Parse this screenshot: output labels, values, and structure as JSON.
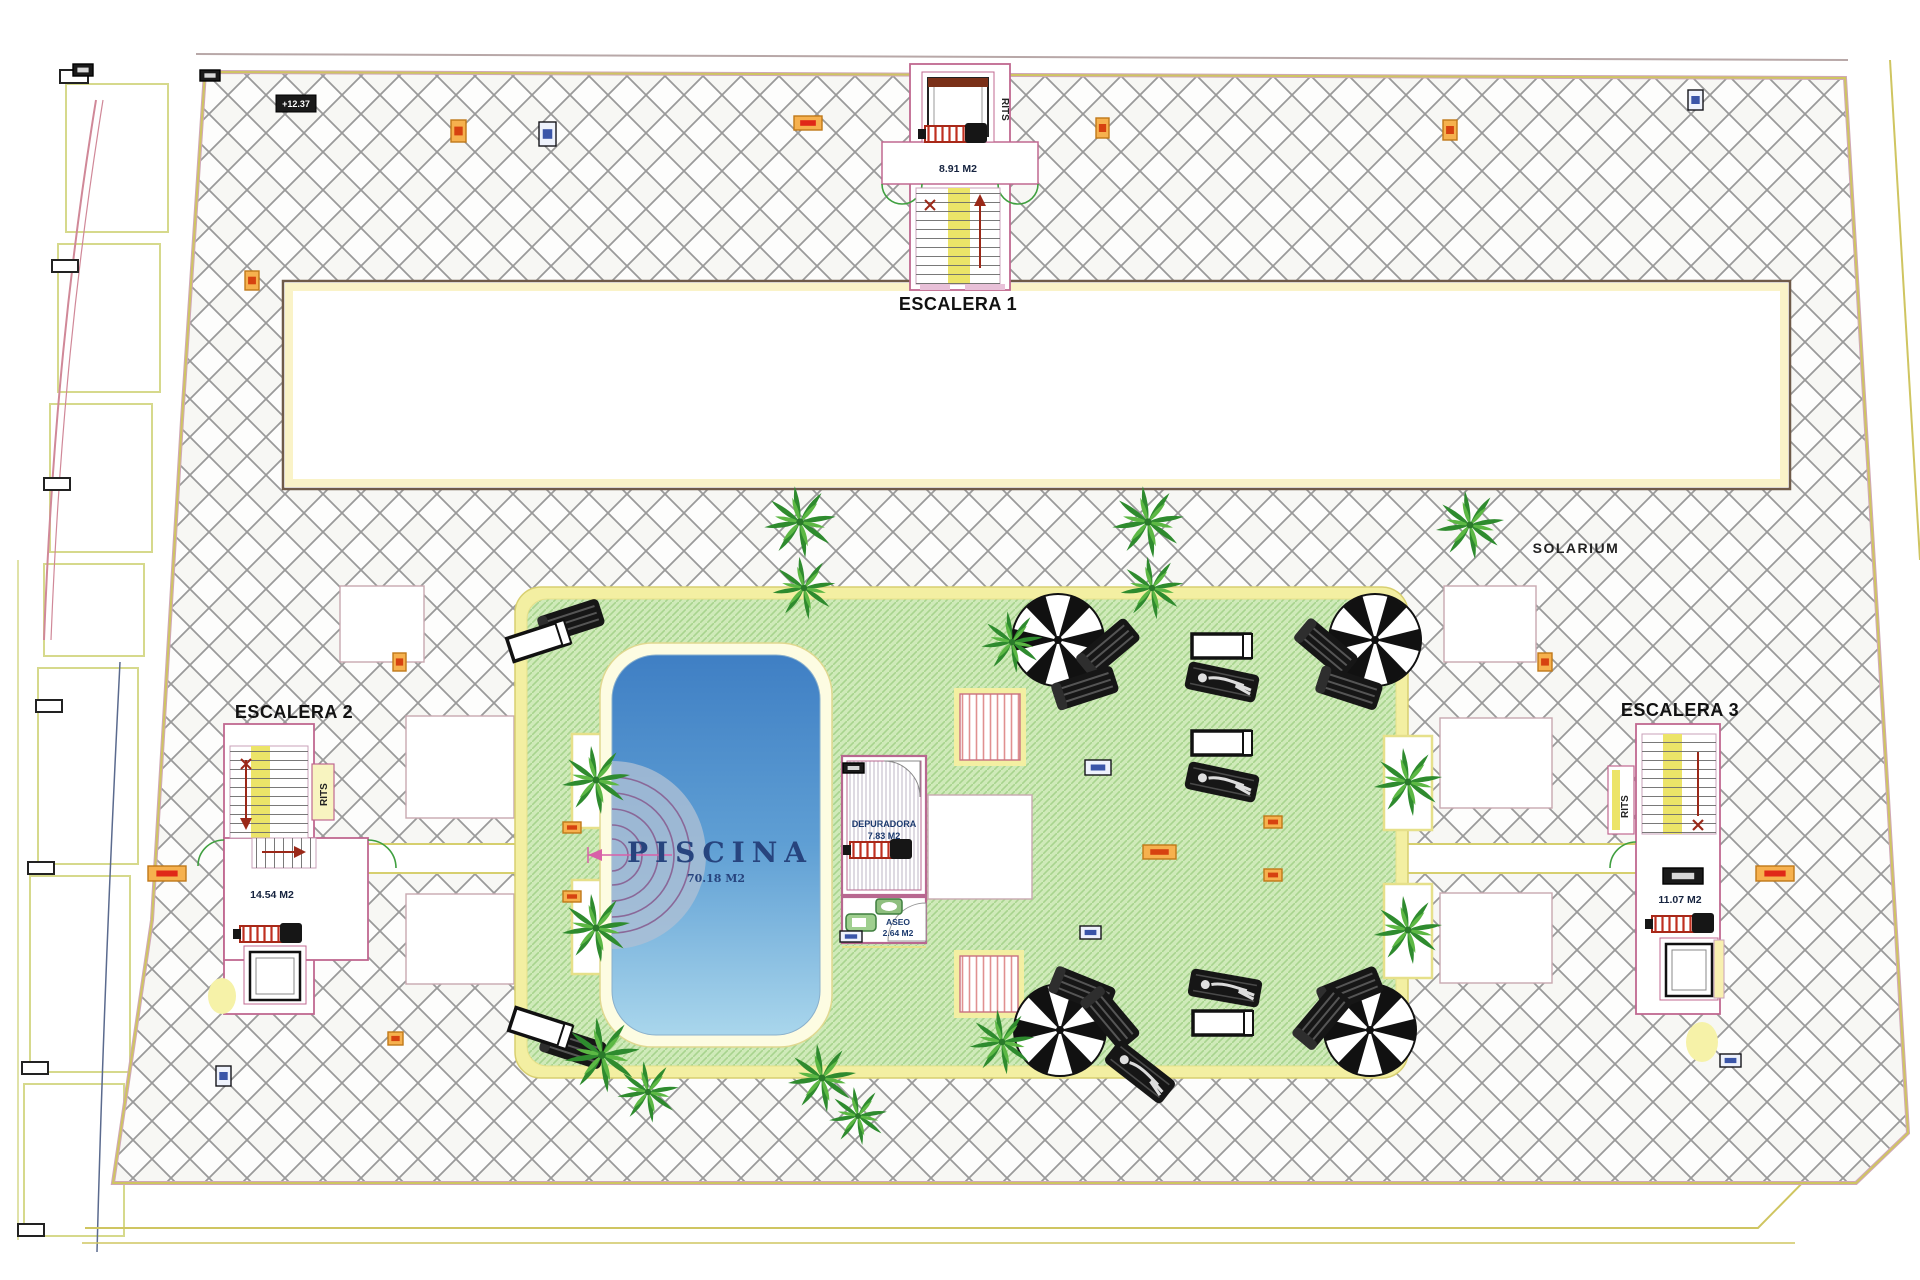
{
  "plan": {
    "solarium_label": "SOLARIUM",
    "level_marker": "+12.37",
    "escalera1": {
      "title": "ESCALERA 1",
      "area": "8.91 M2",
      "rits": "RITS"
    },
    "escalera2": {
      "title": "ESCALERA 2",
      "area": "14.54 M2",
      "rits": "RITS"
    },
    "escalera3": {
      "title": "ESCALERA 3",
      "area": "11.07 M2",
      "rits": "RITS"
    },
    "piscina": {
      "title": "PISCINA",
      "area": "70.18 M2"
    },
    "depuradora": {
      "title": "DEPURADORA",
      "area": "7.83 M2"
    },
    "aseo": {
      "title": "ASEO",
      "area": "2.64 M2"
    }
  },
  "colors": {
    "hatch_line": "#9a9a9a",
    "site_border_yellow": "#cfc561",
    "site_border_pink": "#d0a8b8",
    "deck_border": "#f3efa2",
    "deck_green": "#cfeab9",
    "deck_stripe": "#a8d48e",
    "pool_top": "#3f7fc4",
    "pool_bottom": "#a9d6ec",
    "room_outline": "#b86890",
    "stair_yellow": "#ece468",
    "door_arc_green": "#3f9f3f",
    "text_navy": "#1c3a6e",
    "red_arrow": "#9a2818"
  },
  "marker_styles": {
    "orange": {
      "fill": "#f6b14e",
      "stroke": "#c07818",
      "inner": "#d64210"
    },
    "blue": {
      "fill": "#eef2fc",
      "stroke": "#15151a",
      "inner": "#3a55a8"
    },
    "black": {
      "fill": "#1a1a1a",
      "stroke": "#000000",
      "inner": "#d8d8d8"
    },
    "red": {
      "fill": "#f6b14e",
      "stroke": "#c07818",
      "inner": "#e02818"
    }
  },
  "markers": [
    {
      "x": 73,
      "y": 64,
      "w": 20,
      "h": 12,
      "type": "black"
    },
    {
      "x": 200,
      "y": 70,
      "w": 20,
      "h": 11,
      "type": "black"
    },
    {
      "x": 451,
      "y": 120,
      "w": 15,
      "h": 22,
      "type": "orange"
    },
    {
      "x": 539,
      "y": 122,
      "w": 17,
      "h": 24,
      "type": "blue"
    },
    {
      "x": 794,
      "y": 116,
      "w": 28,
      "h": 14,
      "type": "red"
    },
    {
      "x": 1096,
      "y": 118,
      "w": 13,
      "h": 20,
      "type": "orange"
    },
    {
      "x": 1443,
      "y": 120,
      "w": 14,
      "h": 20,
      "type": "orange"
    },
    {
      "x": 1688,
      "y": 90,
      "w": 15,
      "h": 20,
      "type": "blue"
    },
    {
      "x": 245,
      "y": 271,
      "w": 14,
      "h": 19,
      "type": "orange"
    },
    {
      "x": 393,
      "y": 653,
      "w": 13,
      "h": 18,
      "type": "orange"
    },
    {
      "x": 148,
      "y": 866,
      "w": 38,
      "h": 15,
      "type": "red"
    },
    {
      "x": 388,
      "y": 1032,
      "w": 15,
      "h": 13,
      "type": "orange"
    },
    {
      "x": 216,
      "y": 1066,
      "w": 15,
      "h": 20,
      "type": "blue"
    },
    {
      "x": 563,
      "y": 822,
      "w": 18,
      "h": 11,
      "type": "orange"
    },
    {
      "x": 563,
      "y": 891,
      "w": 18,
      "h": 11,
      "type": "orange"
    },
    {
      "x": 1085,
      "y": 760,
      "w": 26,
      "h": 15,
      "type": "blue"
    },
    {
      "x": 1080,
      "y": 926,
      "w": 21,
      "h": 13,
      "type": "blue"
    },
    {
      "x": 1143,
      "y": 845,
      "w": 33,
      "h": 14,
      "type": "orange"
    },
    {
      "x": 1264,
      "y": 816,
      "w": 18,
      "h": 12,
      "type": "orange"
    },
    {
      "x": 1264,
      "y": 869,
      "w": 18,
      "h": 12,
      "type": "orange"
    },
    {
      "x": 1538,
      "y": 653,
      "w": 14,
      "h": 18,
      "type": "orange"
    },
    {
      "x": 1756,
      "y": 866,
      "w": 38,
      "h": 15,
      "type": "red"
    },
    {
      "x": 1720,
      "y": 1054,
      "w": 21,
      "h": 13,
      "type": "blue"
    },
    {
      "x": 840,
      "y": 931,
      "w": 22,
      "h": 11,
      "type": "blue"
    },
    {
      "x": 843,
      "y": 763,
      "w": 21,
      "h": 10,
      "type": "black"
    },
    {
      "x": 1663,
      "y": 868,
      "w": 40,
      "h": 16,
      "type": "black"
    }
  ]
}
